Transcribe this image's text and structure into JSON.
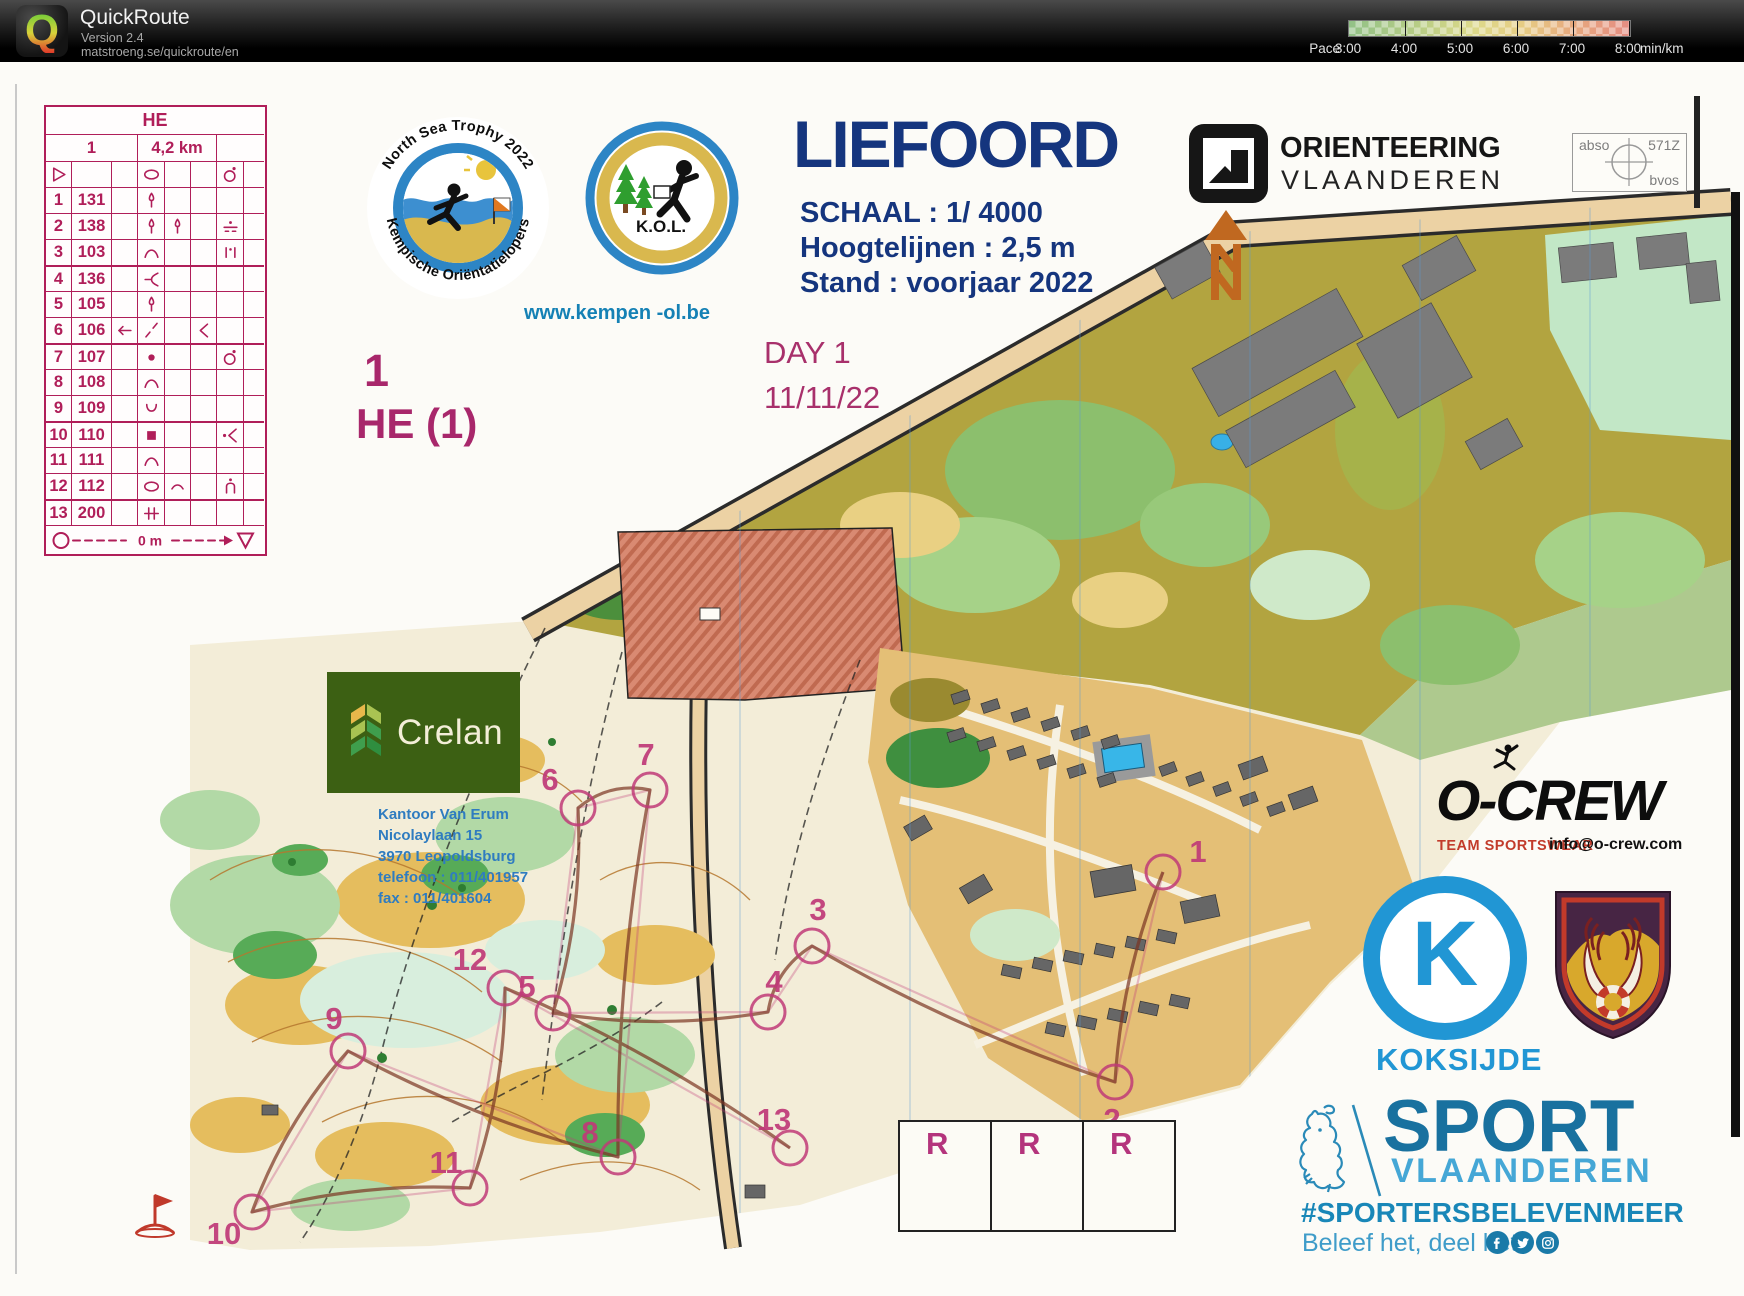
{
  "app": {
    "name": "QuickRoute",
    "version": "Version 2.4",
    "url": "matstroeng.se/quickroute/en",
    "logo_letter": "Q"
  },
  "pace_legend": {
    "label": "Pace",
    "unit": "min/km",
    "ticks": [
      "3:00",
      "4:00",
      "5:00",
      "6:00",
      "7:00",
      "8:00"
    ]
  },
  "control_sheet": {
    "header": "HE",
    "course_number": "1",
    "length": "4,2 km",
    "symbol_row": [
      "start-triangle",
      "",
      "",
      "oval",
      "",
      "",
      "circle-dot",
      ""
    ],
    "rows": [
      {
        "no": "1",
        "code": "131",
        "c": "",
        "d": "tree",
        "e": "",
        "f": "",
        "g": "",
        "h": ""
      },
      {
        "no": "2",
        "code": "138",
        "c": "",
        "d": "tree",
        "e": "tree",
        "f": "",
        "g": "wall-ruin",
        "h": ""
      },
      {
        "no": "3",
        "code": "103",
        "c": "",
        "d": "hill",
        "e": "",
        "f": "",
        "g": "ruin",
        "h": ""
      },
      {
        "no": "4",
        "code": "136",
        "c": "",
        "d": "spur",
        "e": "",
        "f": "",
        "g": "",
        "h": ""
      },
      {
        "no": "5",
        "code": "105",
        "c": "",
        "d": "tree",
        "e": "",
        "f": "",
        "g": "",
        "h": ""
      },
      {
        "no": "6",
        "code": "106",
        "c": "arrow-left",
        "d": "slash",
        "e": "",
        "f": "angle",
        "g": "",
        "h": ""
      },
      {
        "no": "7",
        "code": "107",
        "c": "",
        "d": "dot",
        "e": "",
        "f": "",
        "g": "circle-dot",
        "h": ""
      },
      {
        "no": "8",
        "code": "108",
        "c": "",
        "d": "hill",
        "e": "",
        "f": "",
        "g": "",
        "h": ""
      },
      {
        "no": "9",
        "code": "109",
        "c": "",
        "d": "u-shape",
        "e": "",
        "f": "",
        "g": "",
        "h": ""
      },
      {
        "no": "10",
        "code": "110",
        "c": "",
        "d": "filled-square",
        "e": "",
        "f": "",
        "g": "dot-angle",
        "h": ""
      },
      {
        "no": "11",
        "code": "111",
        "c": "",
        "d": "hill",
        "e": "",
        "f": "",
        "g": "",
        "h": ""
      },
      {
        "no": "12",
        "code": "112",
        "c": "",
        "d": "oval",
        "e": "curve",
        "f": "",
        "g": "n-dot",
        "h": ""
      },
      {
        "no": "13",
        "code": "200",
        "c": "",
        "d": "crossing",
        "e": "",
        "f": "",
        "g": "",
        "h": ""
      }
    ],
    "footer_distance": "0 m"
  },
  "event": {
    "title": "LIEFOORD",
    "scale": "SCHAAL : 1/ 4000",
    "contours": "Hoogtelijnen : 2,5 m",
    "status": "Stand : voorjaar 2022",
    "day": "DAY 1",
    "date": "11/11/22",
    "course_class": "1",
    "course_name": "HE (1)"
  },
  "logos": {
    "nst": {
      "top_text": "North Sea Trophy 2022",
      "bottom_text": "Kempische Oriëntatielopers"
    },
    "kol": {
      "label": "K.O.L.",
      "website": "www.kempen -ol.be"
    },
    "orienteering_vlaanderen": {
      "line1": "ORIENTEERING",
      "line2": "VLAANDEREN"
    },
    "registration_box": {
      "tl": "abso",
      "tr": "571Z",
      "br": "bvos"
    },
    "crelan": {
      "name": "Crelan",
      "address": [
        "Kantoor Van Erum",
        "Nicolaylaan 15",
        "3970 Leopoldsburg",
        "telefoon : 011/401957",
        "fax : 011/401604"
      ]
    },
    "ocrew": {
      "name": "O-CREW",
      "tagline": "TEAM SPORTSWEAR",
      "email": "info@o-crew.com"
    },
    "koksijde": {
      "letter": "K",
      "name": "KOKSIJDE"
    },
    "sport_vlaanderen": {
      "line1": "SPORT",
      "line2": "VLAANDEREN",
      "hashtag": "#SPORTERSBELEVENMEER",
      "slogan": "Beleef het, deel het!",
      "social": [
        "facebook",
        "twitter",
        "instagram"
      ]
    }
  },
  "r_boxes": [
    "R",
    "R",
    "R"
  ],
  "map": {
    "controls": [
      {
        "n": "1",
        "cx": 1163,
        "cy": 872,
        "lx": 1198,
        "ly": 862
      },
      {
        "n": "2",
        "cx": 1115,
        "cy": 1082,
        "lx": 1112,
        "ly": 1130
      },
      {
        "n": "3",
        "cx": 812,
        "cy": 946,
        "lx": 818,
        "ly": 920
      },
      {
        "n": "4",
        "cx": 768,
        "cy": 1012,
        "lx": 774,
        "ly": 992
      },
      {
        "n": "5",
        "cx": 553,
        "cy": 1013,
        "lx": 527,
        "ly": 997
      },
      {
        "n": "6",
        "cx": 578,
        "cy": 808,
        "lx": 550,
        "ly": 790
      },
      {
        "n": "7",
        "cx": 650,
        "cy": 790,
        "lx": 646,
        "ly": 765
      },
      {
        "n": "8",
        "cx": 618,
        "cy": 1157,
        "lx": 590,
        "ly": 1143
      },
      {
        "n": "9",
        "cx": 348,
        "cy": 1051,
        "lx": 334,
        "ly": 1029
      },
      {
        "n": "10",
        "cx": 252,
        "cy": 1212,
        "lx": 224,
        "ly": 1244
      },
      {
        "n": "11",
        "cx": 470,
        "cy": 1188,
        "lx": 446,
        "ly": 1173
      },
      {
        "n": "12",
        "cx": 505,
        "cy": 988,
        "lx": 470,
        "ly": 970
      },
      {
        "n": "13",
        "cx": 790,
        "cy": 1148,
        "lx": 774,
        "ly": 1130
      }
    ]
  }
}
